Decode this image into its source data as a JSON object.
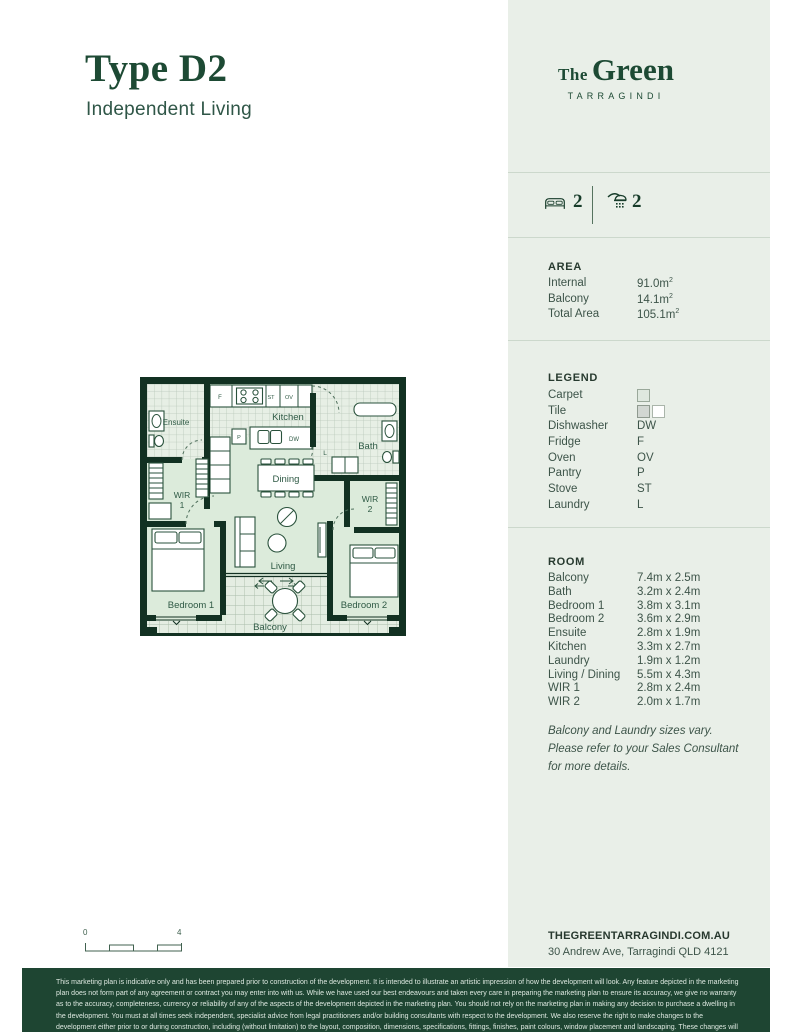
{
  "page": {
    "title": "Type D2",
    "subtitle": "Independent Living"
  },
  "brand": {
    "the": "The",
    "green": "Green",
    "location": "TARRAGINDI"
  },
  "summary": {
    "beds": "2",
    "baths": "2"
  },
  "area": {
    "heading": "AREA",
    "rows": [
      {
        "label": "Internal",
        "value": "91.0m",
        "sup": "2"
      },
      {
        "label": "Balcony",
        "value": "14.1m",
        "sup": "2"
      },
      {
        "label": "Total Area",
        "value": "105.1m",
        "sup": "2"
      }
    ]
  },
  "legend": {
    "heading": "LEGEND",
    "rows": [
      {
        "label": "Carpet",
        "symbol": ""
      },
      {
        "label": "Tile",
        "symbol": ""
      },
      {
        "label": "Dishwasher",
        "symbol": "DW"
      },
      {
        "label": "Fridge",
        "symbol": "F"
      },
      {
        "label": "Oven",
        "symbol": "OV"
      },
      {
        "label": "Pantry",
        "symbol": "P"
      },
      {
        "label": "Stove",
        "symbol": "ST"
      },
      {
        "label": "Laundry",
        "symbol": "L"
      }
    ]
  },
  "room": {
    "heading": "ROOM",
    "rows": [
      {
        "label": "Balcony",
        "value": "7.4m x 2.5m"
      },
      {
        "label": "Bath",
        "value": "3.2m x 2.4m"
      },
      {
        "label": "Bedroom 1",
        "value": "3.8m x 3.1m"
      },
      {
        "label": "Bedroom 2",
        "value": "3.6m x 2.9m"
      },
      {
        "label": "Ensuite",
        "value": "2.8m x 1.9m"
      },
      {
        "label": "Kitchen",
        "value": "3.3m x 2.7m"
      },
      {
        "label": "Laundry",
        "value": "1.9m x 1.2m"
      },
      {
        "label": "Living / Dining",
        "value": "5.5m x 4.3m"
      },
      {
        "label": "WIR 1",
        "value": "2.8m x 2.4m"
      },
      {
        "label": "WIR 2",
        "value": "2.0m x 1.7m"
      }
    ],
    "note": [
      "Balcony and Laundry sizes vary.",
      "Please refer to your Sales Consultant",
      "for more details."
    ]
  },
  "floorplan": {
    "labels": {
      "ensuite": "Ensuite",
      "kitchen": "Kitchen",
      "bath": "Bath",
      "dining": "Dining",
      "living": "Living",
      "balcony": "Balcony",
      "bedroom1": "Bedroom 1",
      "bedroom2": "Bedroom 2",
      "wir1_line1": "WIR",
      "wir1_line2": "1",
      "wir2_line1": "WIR",
      "wir2_line2": "2",
      "fridge": "F",
      "stove": "ST",
      "oven": "OV",
      "pantry": "P",
      "dishwasher": "DW",
      "laundry": "L"
    }
  },
  "scalebar": {
    "start": "0",
    "end": "4"
  },
  "contact": {
    "website": "THEGREENTARRAGINDI.COM.AU",
    "address": "30 Andrew Ave, Tarragindi QLD 4121"
  },
  "footer": {
    "disclaimer": "This marketing plan is indicative only and has been prepared prior to construction of the development. It is intended to illustrate an artistic impression of how the development will look. Any feature depicted in the marketing plan does not form part of any agreement or contract you may enter into with us. While we have used our best endeavours and taken every care in preparing the marketing plan to ensure its accuracy, we give no warranty as to the accuracy, completeness, currency or reliability of any of the aspects of the development depicted in the marketing plan. You should not rely on the marketing plan in making any decision to purchase a dwelling in the development. You must at all times seek independent, specialist advice from legal practitioners and/or building consultants with respect to the development. We also reserve the right to make changes to the development either prior to or during construction, including (without limitation) to the layout, composition, dimensions, specifications, fittings, finishes, paint colours, window placement and landscaping. These changes will not necessarily be reflected in the marketing plan."
  },
  "colors": {
    "brand_green": "#1d4a34",
    "panel_bg": "#e9efe8",
    "footer_bg": "#1e4532",
    "plan_wall": "#123122",
    "carpet": "#dcebdb",
    "tile_line": "#b9c8b9"
  }
}
